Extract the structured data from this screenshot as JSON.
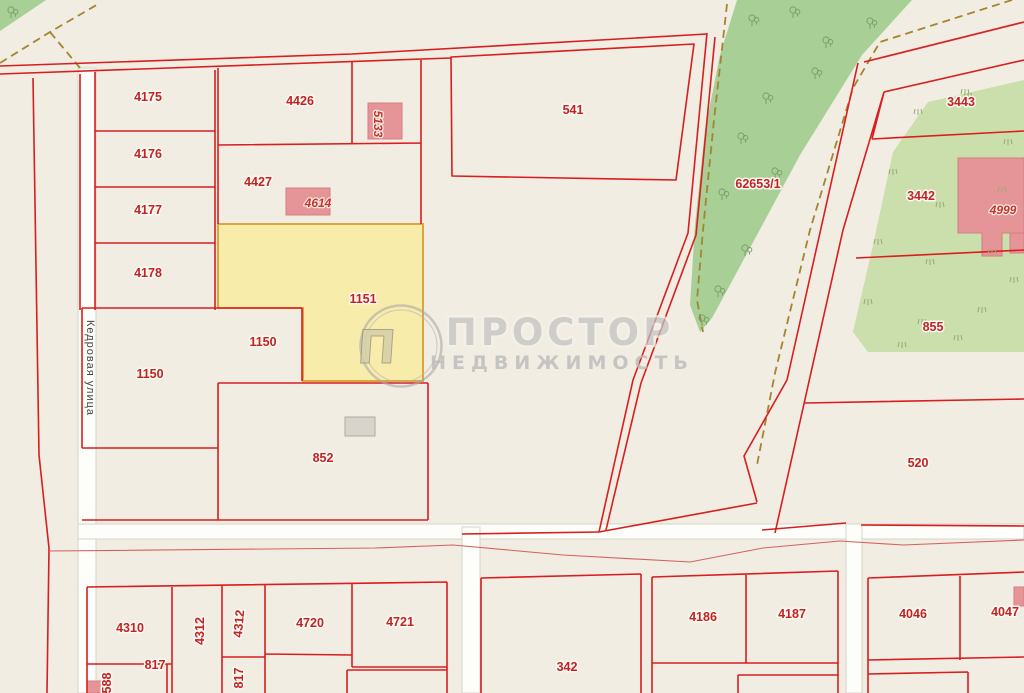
{
  "watermark": {
    "title": "ПРОСТОР",
    "subtitle": "НЕДВИЖИМОСТЬ",
    "logo_letter": "П"
  },
  "street": {
    "name": "Кедровая улица"
  },
  "colors": {
    "background_beige": "#f1ede2",
    "boundary_red": "#d81e1e",
    "label_red": "#c32222",
    "selected_parcel_fill": "#f8ecab",
    "selected_parcel_border": "#dca53d",
    "forest_green": "#a8cf96",
    "scrub_green": "#cadfab",
    "building_pink": "#e59598",
    "gray_building": "#d8d4cb",
    "path_dash_olive": "#a5842e",
    "road_white": "#fdfdfa"
  },
  "parcel_labels": [
    {
      "text": "4175",
      "x": 148,
      "y": 101
    },
    {
      "text": "4176",
      "x": 148,
      "y": 158
    },
    {
      "text": "4177",
      "x": 148,
      "y": 214
    },
    {
      "text": "4178",
      "x": 148,
      "y": 277
    },
    {
      "text": "4426",
      "x": 300,
      "y": 105
    },
    {
      "text": "4427",
      "x": 258,
      "y": 186
    },
    {
      "text": "541",
      "x": 573,
      "y": 114
    },
    {
      "text": "62653/1",
      "x": 758,
      "y": 188
    },
    {
      "text": "3443",
      "x": 961,
      "y": 106
    },
    {
      "text": "3442",
      "x": 921,
      "y": 200
    },
    {
      "text": "855",
      "x": 933,
      "y": 331
    },
    {
      "text": "520",
      "x": 918,
      "y": 467
    },
    {
      "text": "1151",
      "x": 363,
      "y": 303
    },
    {
      "text": "1150",
      "x": 263,
      "y": 346
    },
    {
      "text": "1150",
      "x": 150,
      "y": 378
    },
    {
      "text": "852",
      "x": 323,
      "y": 462
    },
    {
      "text": "4310",
      "x": 130,
      "y": 632
    },
    {
      "text": "4312",
      "x": 204,
      "y": 631,
      "rot": -90
    },
    {
      "text": "4312",
      "x": 243,
      "y": 624,
      "rot": -85
    },
    {
      "text": "4720",
      "x": 310,
      "y": 627
    },
    {
      "text": "4721",
      "x": 400,
      "y": 626
    },
    {
      "text": "817",
      "x": 155,
      "y": 669
    },
    {
      "text": "817",
      "x": 243,
      "y": 678,
      "rot": -90
    },
    {
      "text": "588",
      "x": 111,
      "y": 683,
      "rot": -90
    },
    {
      "text": "342",
      "x": 567,
      "y": 671
    },
    {
      "text": "4186",
      "x": 703,
      "y": 621
    },
    {
      "text": "4187",
      "x": 792,
      "y": 618
    },
    {
      "text": "4046",
      "x": 913,
      "y": 618
    },
    {
      "text": "4047",
      "x": 1005,
      "y": 616
    }
  ],
  "building_labels": [
    {
      "text": "5133",
      "x": 374,
      "y": 124,
      "rot": 90
    },
    {
      "text": "4614",
      "x": 318,
      "y": 207
    },
    {
      "text": "4999",
      "x": 1003,
      "y": 214
    }
  ],
  "map_symbols": {
    "trees": [
      [
        11,
        14
      ],
      [
        752,
        22
      ],
      [
        793,
        14
      ],
      [
        826,
        44
      ],
      [
        815,
        75
      ],
      [
        766,
        100
      ],
      [
        741,
        140
      ],
      [
        775,
        175
      ],
      [
        722,
        196
      ],
      [
        745,
        252
      ],
      [
        718,
        293
      ],
      [
        702,
        322
      ],
      [
        870,
        25
      ]
    ],
    "grass": [
      [
        918,
        112
      ],
      [
        968,
        96
      ],
      [
        1008,
        142
      ],
      [
        893,
        172
      ],
      [
        940,
        205
      ],
      [
        1002,
        190
      ],
      [
        878,
        242
      ],
      [
        930,
        262
      ],
      [
        992,
        252
      ],
      [
        868,
        302
      ],
      [
        922,
        322
      ],
      [
        982,
        310
      ],
      [
        1014,
        280
      ],
      [
        902,
        345
      ],
      [
        958,
        338
      ],
      [
        965,
        92
      ]
    ]
  }
}
